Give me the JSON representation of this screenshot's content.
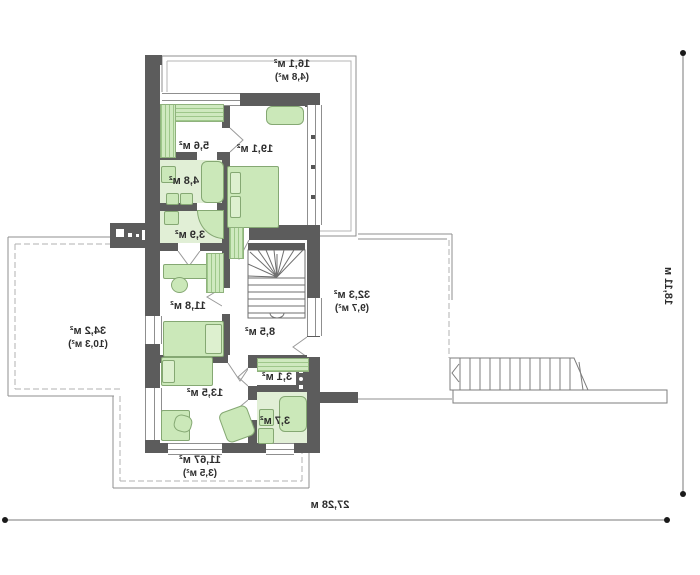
{
  "title": "second-floor-plan-mirrored",
  "rooms": {
    "balcony_top": {
      "area": "16,1 м²",
      "extra": "(4,8 м²)"
    },
    "wardrobe": {
      "area": "5,6 м²"
    },
    "bedroom": {
      "area": "19,1 м²"
    },
    "bathroom_upper": {
      "area": "4,8 м²"
    },
    "utility": {
      "area": "3,9 м²"
    },
    "bedroom_left": {
      "area": "11,8 м²"
    },
    "hall": {
      "area": "8,5 м²"
    },
    "terrace_left": {
      "area": "34,2 м²",
      "extra": "(10,3 м²)"
    },
    "terrace_right": {
      "area": "32,3 м²",
      "extra": "(9,7 м²)"
    },
    "bedroom_lower": {
      "area": "13,5 м²"
    },
    "closet": {
      "area": "3,1 м²"
    },
    "bathroom_lower": {
      "area": "3,7 м²"
    },
    "terrace_bottom": {
      "area": "11,67 м²",
      "extra": "(3,5 м²)"
    }
  },
  "dimensions": {
    "total_width": "27,28 м",
    "total_height": "18,11 м"
  },
  "colors": {
    "wall": "#5c5c5c",
    "thin_line": "#8f8f8f",
    "furniture_fill": "#cbe8b9",
    "furniture_border": "#85a873",
    "bath_floor": "#e1efd6",
    "text": "#2d2d2d"
  }
}
